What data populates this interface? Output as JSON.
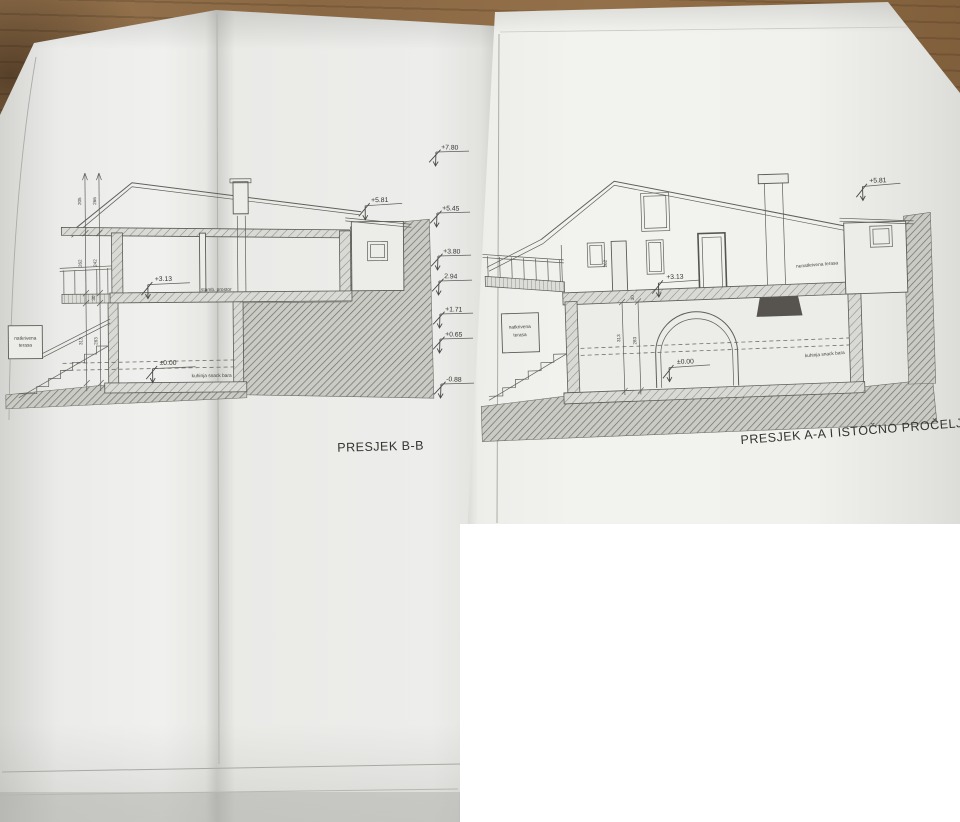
{
  "colors": {
    "wood": "#8a6844",
    "paper": "#ececea",
    "drawing_line": "#5f5f5a",
    "hatch": "#8c8c87",
    "redaction": "#ffffff",
    "text": "#3e3e3a"
  },
  "left_drawing": {
    "title": "PRESJEK B-B",
    "levels": {
      "annex": "+5.81",
      "upper_floor": "+3.13",
      "ground_floor": "±0.00"
    },
    "rooms": {
      "upper": "stamb. prostor",
      "ground": "kuhinja snack bara",
      "terrace": [
        "natkrivena",
        "terasa"
      ]
    },
    "dimensions": {
      "roof_outer": "205",
      "roof_inner": "266",
      "upper_outer": "262",
      "upper_inner": "242",
      "slab": "30",
      "lower_outer": "313",
      "lower_inner": "283"
    }
  },
  "elevation_scale": [
    "+7.80",
    "+5.45",
    "+3.80",
    "2.94",
    "+1.71",
    "+0.65",
    "-0.88"
  ],
  "right_drawing": {
    "title": "PRESJEK A-A I ISTOČNO PROČELJE",
    "levels": {
      "annex": "+5.81",
      "upper_floor": "+3.13",
      "ground_floor": "±0.00"
    },
    "rooms": {
      "upper_terrace": "nenatkrivena terasa",
      "lower_terrace": [
        "natkrivena",
        "terasa"
      ],
      "ground": "kuhinja snack bara"
    },
    "dimensions": {
      "post": "262",
      "slab": "30",
      "lower_outer": "313",
      "lower_inner": "283"
    }
  }
}
